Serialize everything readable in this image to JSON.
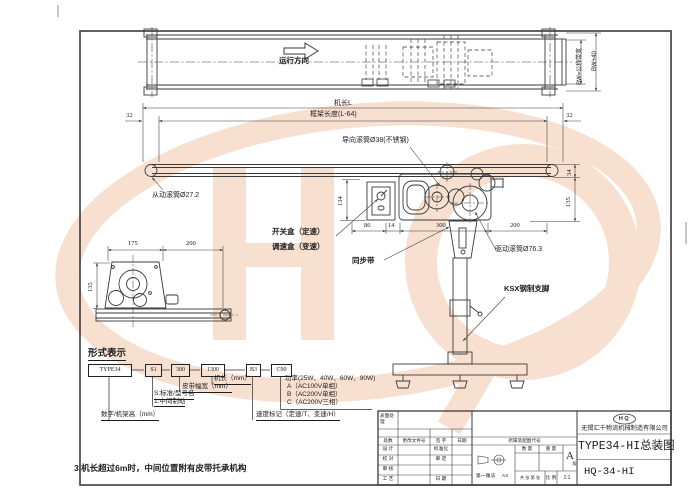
{
  "drawing": {
    "top_view": {
      "direction": "运行方向",
      "belt_width": "BW=公称带宽",
      "overall_width": "BW+40"
    },
    "front_view": {
      "machine_length": "机长L",
      "frame_length": "框架长度(L-64)",
      "end_offset_left": "32",
      "end_offset_right": "32",
      "guide_roller": "导向滚筒Ø38(不锈钢)",
      "driven_roller": "从动滚筒Ø27.2",
      "dim_134": "134",
      "dim_34": "34",
      "dim_135": "135",
      "dim_86": "86",
      "dim_14": "14",
      "dim_300": "300",
      "dim_200": "200",
      "switch_box": "开关盒（定速）",
      "speed_box": "调速盒（变速）",
      "timing_belt": "同步带",
      "drive_roller": "驱动滚筒Ø76.3",
      "support_leg": "KSX钢制支脚"
    },
    "detail_view": {
      "dim_175": "175",
      "dim_200": "200",
      "dim_135": "135"
    }
  },
  "model_code": {
    "heading": "形式表示",
    "segments": [
      "TYPE34",
      "S1",
      "300",
      "1300",
      "B3",
      "C90"
    ],
    "machine_length": "机长（mm）",
    "belt_width": "皮带幅宽（mm）",
    "standard": "S:标准/型号名",
    "middle_drive": "1:中间制动",
    "frame_height": "数字/机架高（mm）",
    "power": "功率(25W、40W、60W、90W)",
    "power_a": "A（AC100V单相）",
    "power_b": "B（AC200V单相）",
    "power_c": "C（AC200V三相）",
    "speed_mark": "速度标记（定速/T、变速/H）"
  },
  "note": "3.机长超过6m时，中间位置附有皮带托承机构",
  "title_block": {
    "surface_treatment": "表面处理",
    "rev_headers": [
      "处数",
      "更改文件号",
      "签 字",
      "日期"
    ],
    "roles": [
      "设 计",
      "校 对",
      "审 核",
      "工 艺"
    ],
    "roles_right": [
      "标准化",
      "审 定",
      "日 期"
    ],
    "assembly_code": "所属装配图代号",
    "projection_label": "第一角法",
    "sheet_size": "A3",
    "quantity_label": "数 量",
    "weight_label": "重 量",
    "stage_mark": "A",
    "stage_suffix": "版",
    "sheet_info": "共 张 第 张",
    "scale_label": "比 例",
    "scale_value": "1:1",
    "logo_text": "HQ",
    "company": "无锡汇千物流机械制造有限公司",
    "drawing_title": "TYPE34-HI总装图",
    "drawing_no": "HQ-34-HI"
  }
}
